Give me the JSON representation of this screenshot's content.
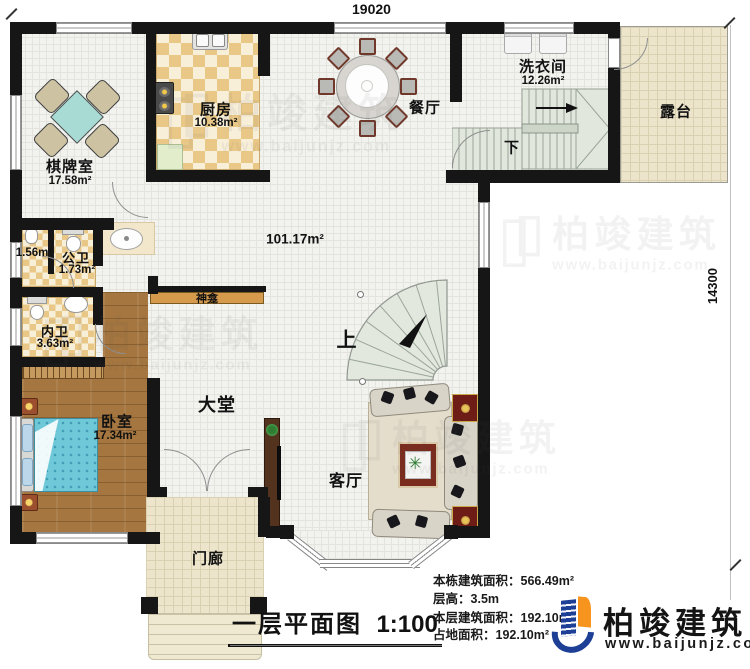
{
  "dimensions": {
    "top": "19020",
    "right": "14300"
  },
  "rooms": {
    "game_room": {
      "name": "棋牌室",
      "area": "17.58m²"
    },
    "kitchen": {
      "name": "厨房",
      "area": "10.38m²"
    },
    "dining": {
      "name": "餐厅"
    },
    "laundry": {
      "name": "洗衣间",
      "area": "12.26m²"
    },
    "terrace": {
      "name": "露台"
    },
    "closet": {
      "area": "1.56m²"
    },
    "public_bath": {
      "name": "公卫",
      "area": "1.73m²"
    },
    "inner_bath": {
      "name": "内卫",
      "area": "3.63m²"
    },
    "bedroom": {
      "name": "卧室",
      "area": "17.34m²"
    },
    "hall": {
      "name": "大堂"
    },
    "living": {
      "name": "客厅"
    },
    "porch": {
      "name": "门廊"
    },
    "shrine": {
      "name": "神龛"
    },
    "open_area": {
      "area": "101.17m²"
    }
  },
  "stairs": {
    "up": "上",
    "down": "下"
  },
  "title": {
    "text": "一层平面图",
    "scale": "1:100"
  },
  "stats": {
    "lines": [
      {
        "label": "本栋建筑面积：",
        "value": "566.49m²"
      },
      {
        "label": "层高：",
        "value": "3.5m"
      },
      {
        "label": "本层建筑面积：",
        "value": "192.10m²"
      },
      {
        "label": "占地面积：",
        "value": "192.10m²"
      }
    ]
  },
  "logo": {
    "name": "柏竣建筑",
    "url": "www.baijunjz.com"
  },
  "watermark": {
    "name": "柏竣建筑",
    "url": "www.baijunjz.com"
  }
}
